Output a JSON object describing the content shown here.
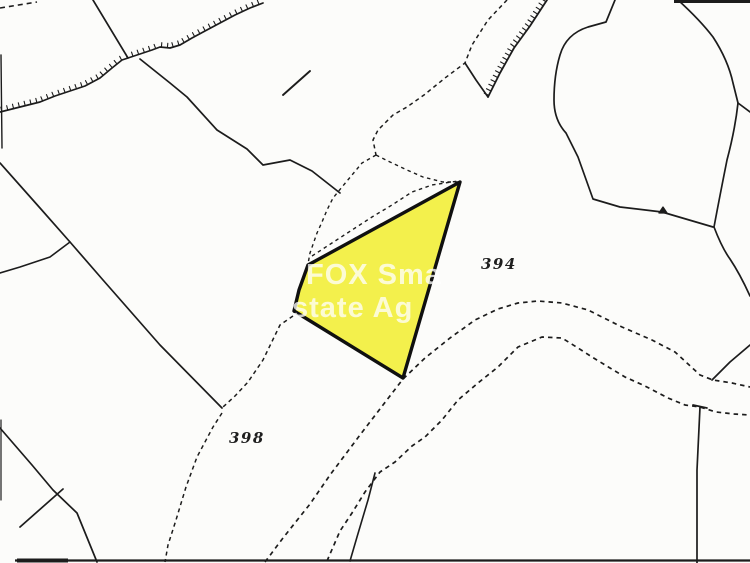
{
  "map": {
    "background": "#fcfcfa",
    "ink": "#1c1c1c",
    "watermark": {
      "line1": "FOX Sma",
      "line2": "state Ag",
      "color": "#ffffff"
    },
    "parcel_labels": [
      {
        "text": "394"
      },
      {
        "text": "398"
      }
    ],
    "highlight_parcel": {
      "fill": "#f3f04c",
      "stroke": "#101010",
      "stroke_width": 3.4,
      "points": "460,182 308,265 299,290 294,311 403,378"
    },
    "solid_paths": [
      {
        "d": "M93,0 L128,58",
        "w": 1.7
      },
      {
        "d": "M140,59 L170,83 L187,97 L217,130 L247,149 L263,165 L290,160 L312,171 L340,193",
        "w": 1.7
      },
      {
        "d": "M283,95 L310,71",
        "w": 1.9
      },
      {
        "d": "M0,163 L40,208 L70,242 L103,280 L160,345 L222,408",
        "w": 1.7
      },
      {
        "d": "M70,242 L50,257 L20,267 L0,273",
        "w": 1.6
      },
      {
        "d": "M0,428 L32,465 L53,490 L77,513 L97,562",
        "w": 1.7
      },
      {
        "d": "M20,527 L63,489",
        "w": 1.7
      },
      {
        "d": "M1,55 L2,148",
        "w": 1.4
      },
      {
        "d": "M1,420 L1,500",
        "w": 1.2
      },
      {
        "d": "M615,0 L606,22 L588,27 Q566,34 560,55 Q554,75 554,100 Q554,120 566,133 L578,157 L593,199 L620,207 L662,212 L713,227",
        "w": 1.7
      },
      {
        "d": "M678,0 Q700,20 713,37 Q728,60 733,83 L738,103 Q735,130 727,160 Q720,195 714,227 Q722,248 730,259 Q740,274 750,296",
        "w": 1.7
      },
      {
        "d": "M738,103 L750,112",
        "w": 1.7
      },
      {
        "d": "M750,345 L730,362 L712,380",
        "w": 1.7
      },
      {
        "d": "M700,407 L697,470 L697,563",
        "w": 1.7
      },
      {
        "d": "M693,405 L707,408",
        "w": 1.7
      },
      {
        "d": "M375,473 L368,500 L357,537 L350,561",
        "w": 1.6
      },
      {
        "d": "M465,63 L476,80 L488,97",
        "w": 1.7
      },
      {
        "d": "M659,213 L663,207 L667,213 Z",
        "w": 1.3,
        "fill": true
      }
    ],
    "dashed_paths": [
      {
        "d": "M0,8 L37,2",
        "dash": "5 4",
        "w": 1.6
      },
      {
        "d": "M507,0 L488,20 L472,45 L465,63 L445,78 L424,95 L407,107 L393,115 L378,130 L373,140 L376,155",
        "dash": "4 3.5",
        "w": 1.5
      },
      {
        "d": "M376,155 L362,163 L352,175 L342,187 L333,198 L327,210 L322,222 L317,233 L310,253 L308,264",
        "dash": "3.5 3.5",
        "w": 1.4
      },
      {
        "d": "M376,155 L390,162 L407,170 L423,177 L443,182 L459,182",
        "dash": "3.5 3.5",
        "w": 1.4
      },
      {
        "d": "M312,256 L332,243 L352,230 L372,217 L392,205 L412,192 L432,185 L458,181",
        "dash": "3.5 3.5",
        "w": 1.4
      },
      {
        "d": "M293,316 L280,325 L263,360 L248,382 L235,396 L223,407",
        "dash": "4 3.5",
        "w": 1.5
      },
      {
        "d": "M222,413 L213,427 L197,457 L186,487 L176,520 L168,545 L165,562",
        "dash": "4 3.5",
        "w": 1.5
      },
      {
        "d": "M265,562 L283,538 L310,504 L330,475 L360,435 L383,405 L403,379 L425,358 L450,338 L475,320 L498,309 L518,303 L538,301 L562,303 L588,310 L622,327 L652,340 L675,352 L700,375 L713,380 L732,383 L750,387",
        "dash": "4.5 4",
        "w": 1.7
      },
      {
        "d": "M327,561 L340,531 L352,513 L365,492 L380,472 L395,462 L412,446 L425,437 L442,420 L458,400 L478,383 L498,367 L518,347 L542,337 L562,338 L578,348 L592,357 L610,368 L625,377 L645,386 L668,398 L685,405 L700,407 L716,412 L734,414 L750,415",
        "dash": "4.5 4",
        "w": 1.7
      }
    ],
    "hatched_paths": [
      {
        "d": "M0,112 L20,107 L40,102 L55,96 L70,91 L85,86 L100,78 L112,68 L122,60 L128,58 L140,54 L152,50 L160,47 L170,48 L180,45 L192,38 L205,31 L220,23 L235,15 L250,8 L263,3",
        "side": -1,
        "len": 4.5,
        "gap": 6,
        "w": 1.7
      },
      {
        "d": "M547,0 L530,26 L514,48 L500,73 L488,97",
        "side": 1,
        "len": 5,
        "gap": 5,
        "w": 1.8
      }
    ],
    "border_paths": [
      {
        "d": "M674,1.5 L750,1.5",
        "w": 3
      },
      {
        "d": "M15,560.5 L750,560.5",
        "w": 2.2
      },
      {
        "d": "M17,560.5 L68,560.5",
        "w": 4
      }
    ]
  }
}
